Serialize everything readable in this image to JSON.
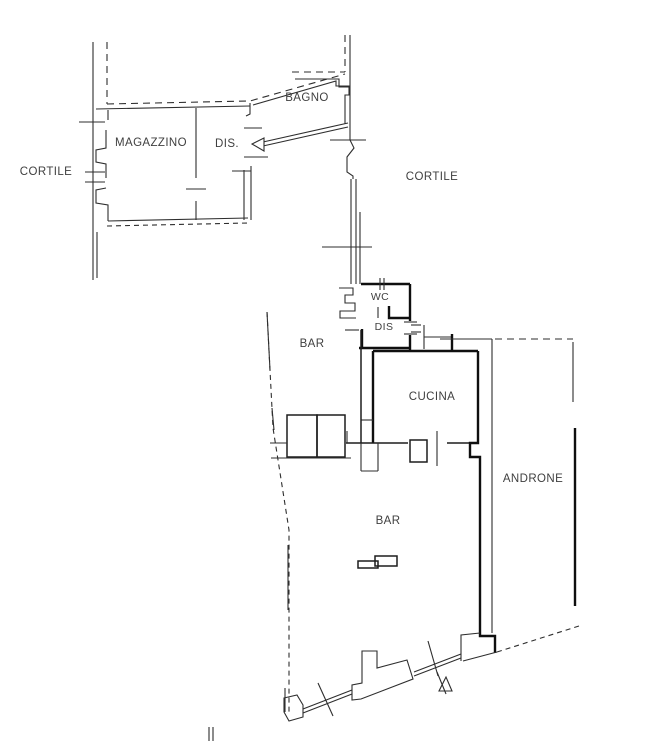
{
  "colors": {
    "background": "#ffffff",
    "wall_line": "#2e2e2e",
    "thick_wall_line": "#0f0f0f",
    "label_text": "#3f3f3f"
  },
  "rooms": {
    "cortile_left": {
      "label": "CORTILE"
    },
    "magazzino": {
      "label": "MAGAZZINO"
    },
    "dis_top": {
      "label": "DIS."
    },
    "bagno": {
      "label": "BAGNO"
    },
    "cortile_right": {
      "label": "CORTILE"
    },
    "wc": {
      "label": "WC"
    },
    "dis_mid": {
      "label": "DIS"
    },
    "bar_upper": {
      "label": "BAR"
    },
    "cucina": {
      "label": "CUCINA"
    },
    "androne": {
      "label": "ANDRONE"
    },
    "bar_lower": {
      "label": "BAR"
    }
  },
  "symbols": {
    "stair_arrow": "stair-direction-arrow",
    "entrance_marker": "entrance-triangle-symbol",
    "window_ticks": "window-tick-marks"
  }
}
